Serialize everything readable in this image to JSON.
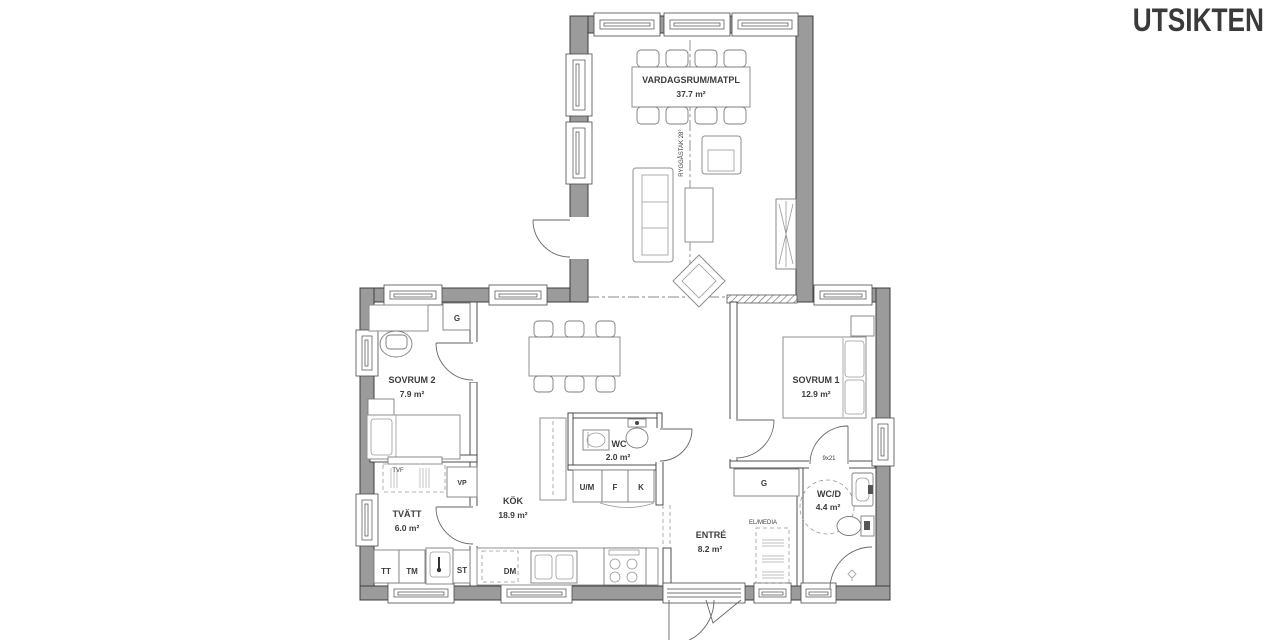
{
  "title": "UTSIKTEN",
  "rooms": {
    "vardagsrum": {
      "name": "VARDAGSRUM/MATPL",
      "area": "37.7 m²"
    },
    "sovrum2": {
      "name": "SOVRUM 2",
      "area": "7.9 m²"
    },
    "sovrum1": {
      "name": "SOVRUM 1",
      "area": "12.9 m²"
    },
    "kok": {
      "name": "KÖK",
      "area": "18.9 m²"
    },
    "tvatt": {
      "name": "TVÄTT",
      "area": "6.0 m²"
    },
    "wc": {
      "name": "WC",
      "area": "2.0 m²"
    },
    "entre": {
      "name": "ENTRÉ",
      "area": "8.2 m²"
    },
    "wcd": {
      "name": "WC/D",
      "area": "4.4 m²"
    }
  },
  "annotations": {
    "ridge": "RYGGÅSTAK 28°",
    "door_size": "9x21",
    "el_media": "EL/MEDIA"
  },
  "fixtures": {
    "garderob1": "G",
    "garderob2": "G",
    "tvf": "TVF",
    "vp": "VP",
    "tt": "TT",
    "tm": "TM",
    "st": "ST",
    "um": "U/M",
    "f": "F",
    "k": "K",
    "dm": "DM"
  },
  "colors": {
    "wall": "#9b9b9b",
    "outline": "#3e3e3e",
    "text": "#3c3c3c",
    "title": "#3a3a3a"
  }
}
